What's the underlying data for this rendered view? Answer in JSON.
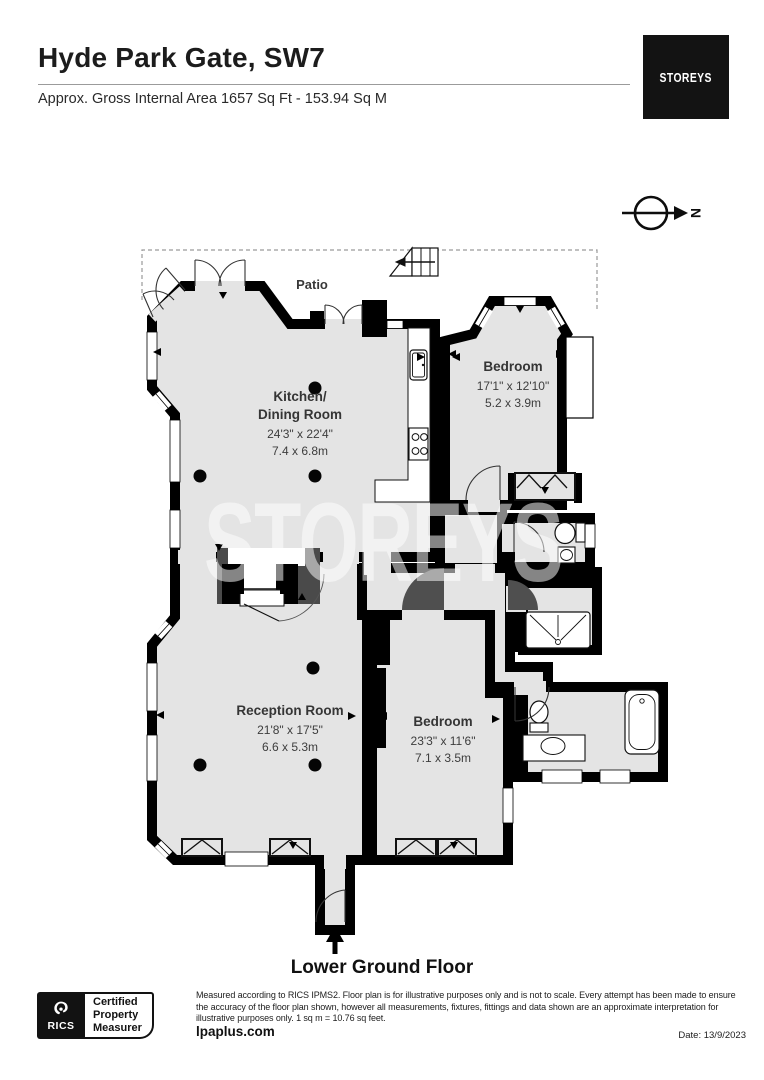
{
  "header": {
    "title": "Hyde Park Gate, SW7",
    "subtitle": "Approx. Gross Internal Area 1657 Sq Ft - 153.94 Sq M",
    "logo": "STOREYS"
  },
  "compass": {
    "label": "N"
  },
  "plan": {
    "watermark": "STOREYS",
    "patio_label": "Patio",
    "rooms": {
      "kitchen": {
        "line1": "Kitchen/",
        "line2": "Dining Room",
        "imperial": "24'3\" x 22'4\"",
        "metric": "7.4 x 6.8m"
      },
      "bedroom1": {
        "name": "Bedroom",
        "imperial": "17'1\" x 12'10\"",
        "metric": "5.2 x 3.9m"
      },
      "reception": {
        "name": "Reception Room",
        "imperial": "21'8\" x 17'5\"",
        "metric": "6.6 x 5.3m"
      },
      "bedroom2": {
        "name": "Bedroom",
        "imperial": "23'3\" x 11'6\"",
        "metric": "7.1 x 3.5m"
      }
    }
  },
  "footer": {
    "floor_label": "Lower Ground Floor",
    "badge": {
      "org": "RICS",
      "lines": [
        "Certified",
        "Property",
        "Measurer"
      ]
    },
    "disclaimer": "Measured according to RICS IPMS2. Floor plan is for illustrative purposes only and is not to scale. Every attempt has been made to ensure the accuracy of the floor plan shown, however all measurements, fixtures, fittings and data shown are an approximate interpretation for illustrative purposes only. 1 sq m = 10.76 sq feet.",
    "website": "lpaplus.com",
    "date": "Date: 13/9/2023"
  },
  "colors": {
    "wall": "#000000",
    "floor": "#e4e4e4",
    "accent_dark": "#4a4a4a"
  }
}
